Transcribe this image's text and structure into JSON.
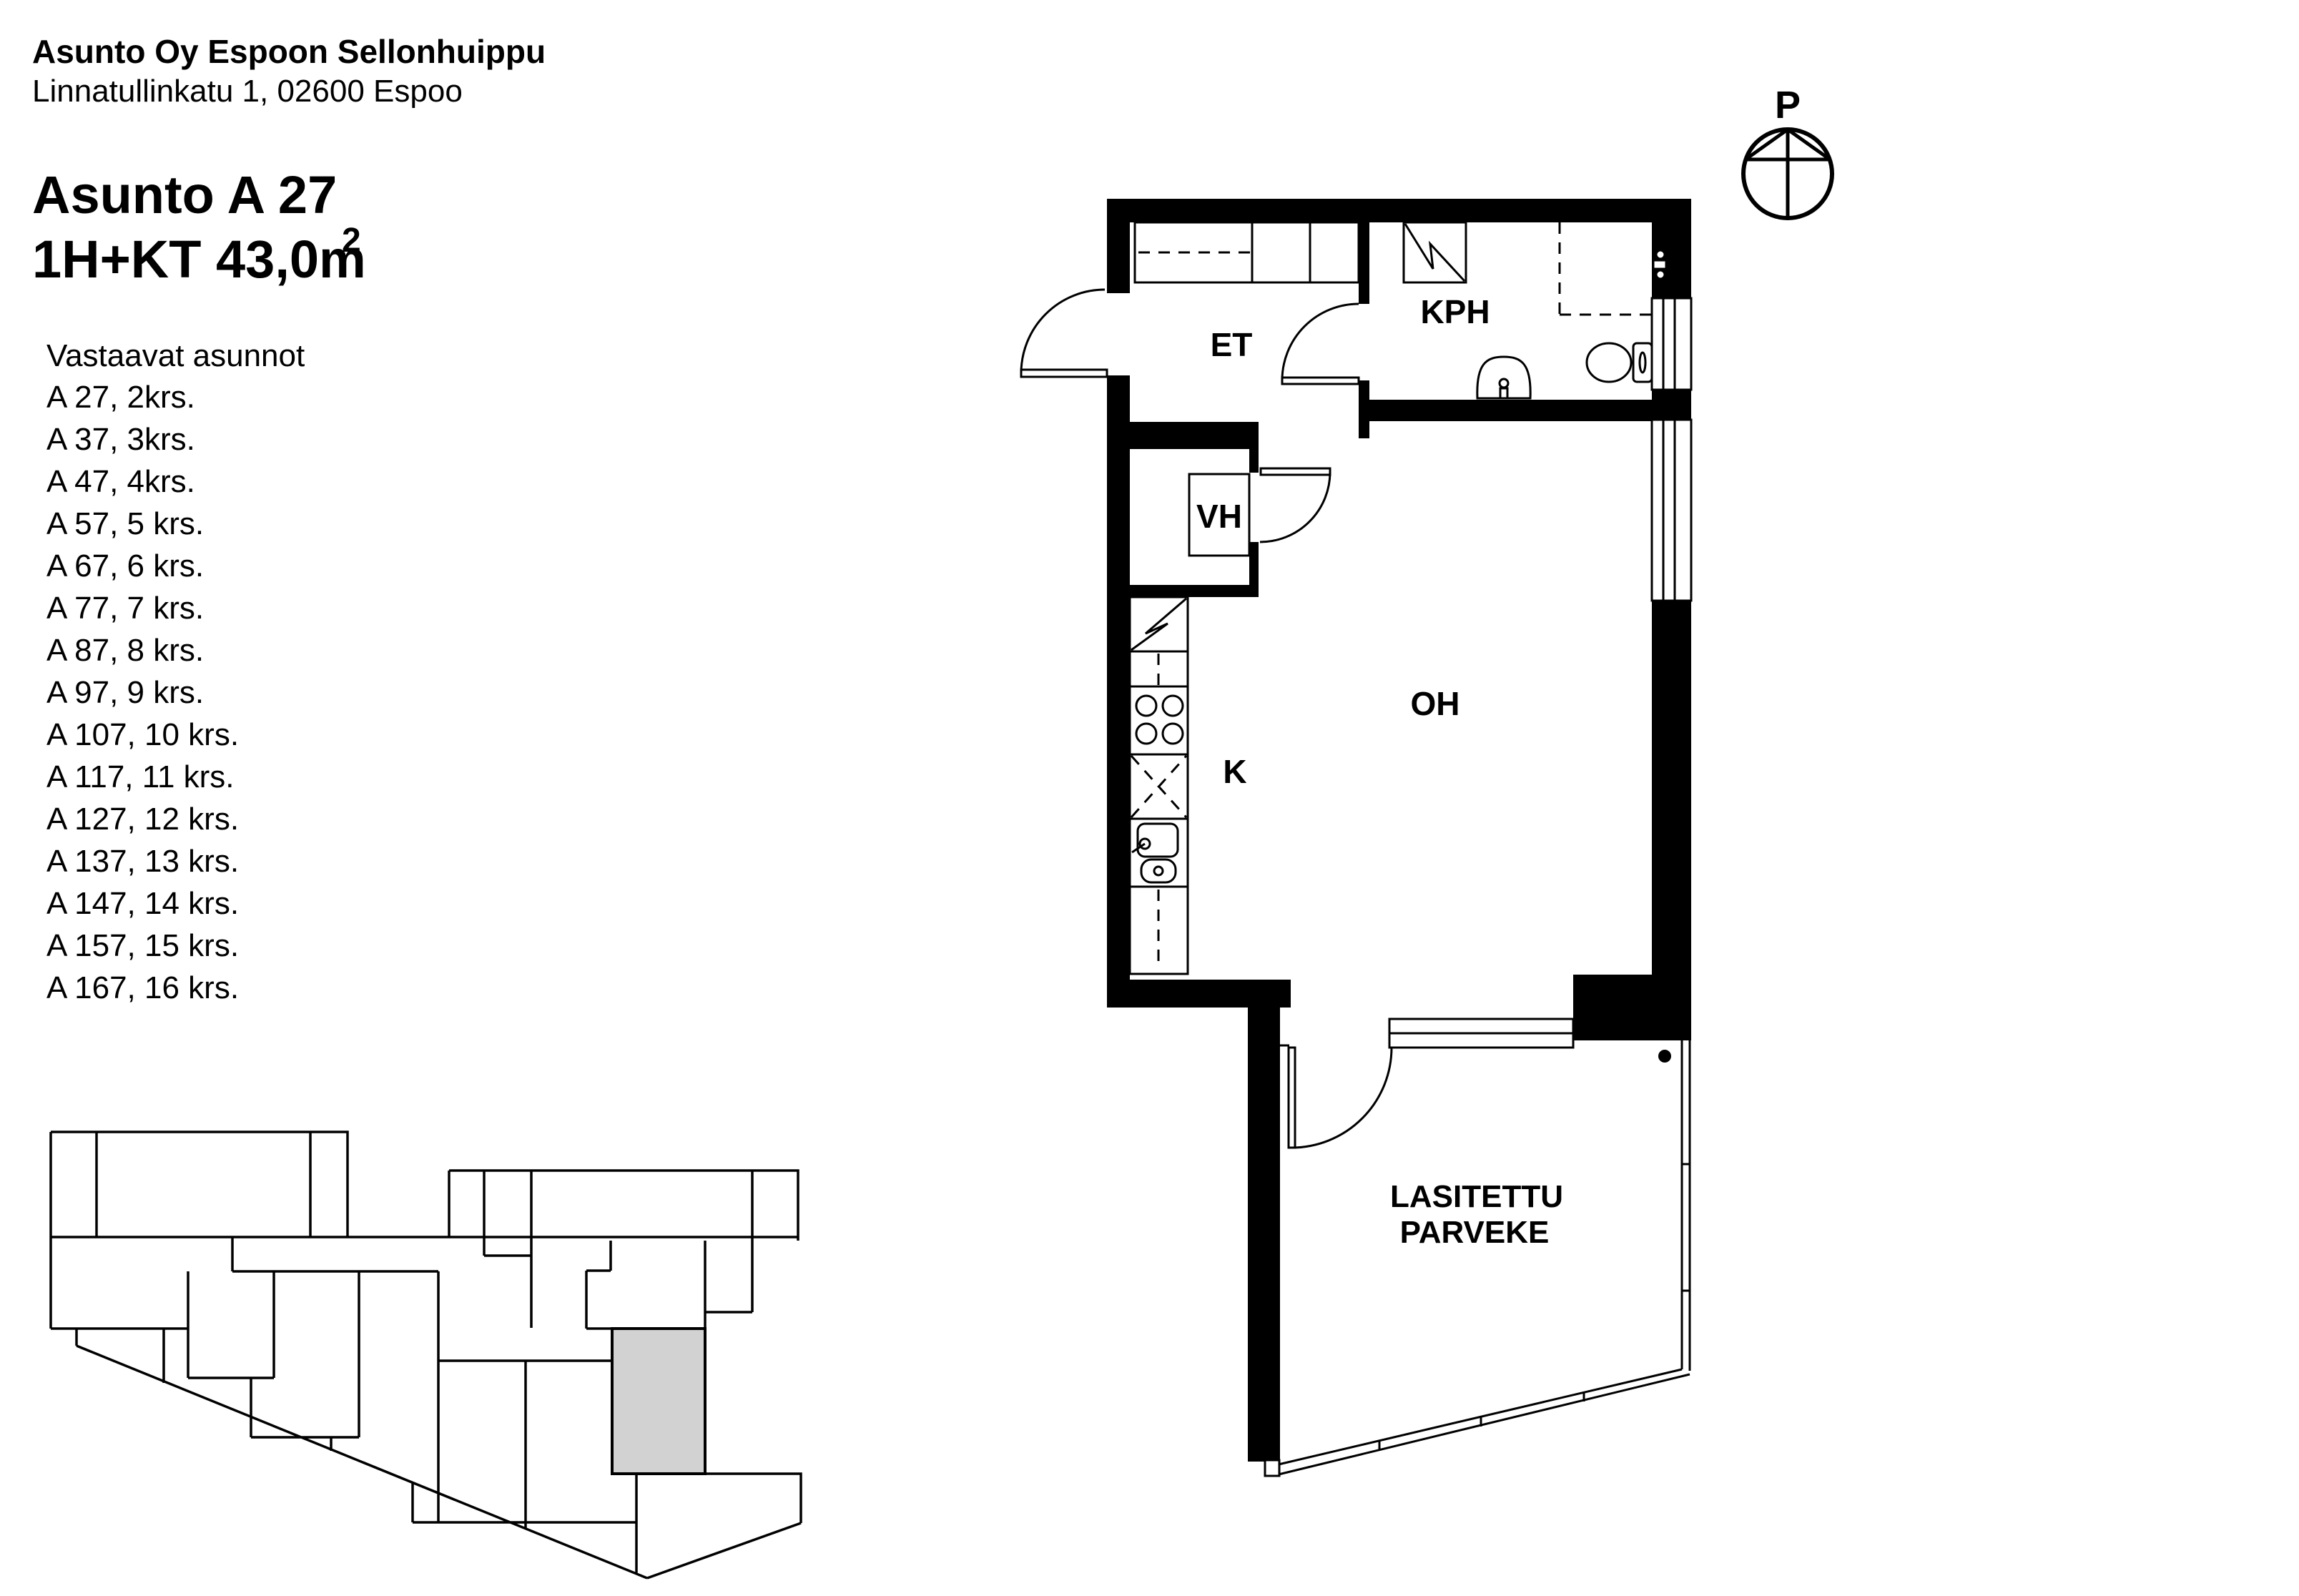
{
  "header": {
    "company": "Asunto Oy Espoon Sellonhuippu",
    "address": "Linnatullinkatu 1, 02600 Espoo",
    "apartment_title": "Asunto A 27",
    "apartment_spec": "1H+KT 43,0m",
    "apartment_spec_superscript": "2"
  },
  "similar_apartments": {
    "heading": "Vastaavat asunnot",
    "items": [
      "A 27, 2krs.",
      "A 37, 3krs.",
      "A 47, 4krs.",
      "A 57, 5 krs.",
      "A 67, 6 krs.",
      "A 77, 7 krs.",
      "A 87, 8 krs.",
      "A 97, 9 krs.",
      "A 107, 10 krs.",
      "A 117, 11 krs.",
      "A 127, 12 krs.",
      "A 137, 13 krs.",
      "A 147, 14 krs.",
      "A 157, 15 krs.",
      "A 167, 16 krs."
    ]
  },
  "floor_plan": {
    "rooms": {
      "entrance": "ET",
      "bathroom": "KPH",
      "closet": "VH",
      "kitchen": "K",
      "living_room": "OH",
      "balcony_line1": "LASITETTU",
      "balcony_line2": "PARVEKE"
    },
    "compass": {
      "north_label": "P"
    }
  },
  "colors": {
    "wall": "#000000",
    "background": "#ffffff",
    "highlighted_unit": "#d2d2d2"
  }
}
